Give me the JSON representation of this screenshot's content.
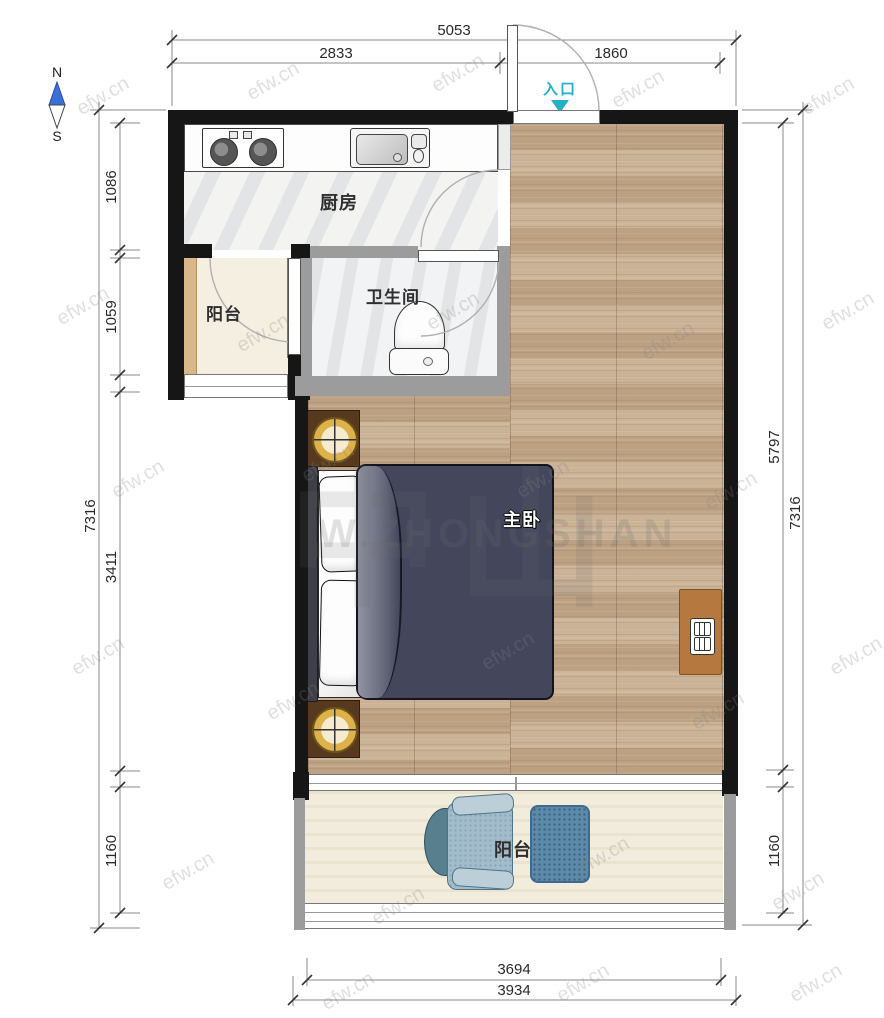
{
  "plan": {
    "compass": {
      "north": "N",
      "south": "S"
    },
    "entrance_label": "入口",
    "rooms": {
      "kitchen": "厨房",
      "bathroom": "卫生间",
      "balcony_left": "阳台",
      "master_bedroom": "主卧",
      "balcony_bottom": "阳台"
    },
    "dimensions_mm": {
      "top_total": "5053",
      "top_left": "2833",
      "top_right": "1860",
      "left_total": "7316",
      "left_seg_1": "1086",
      "left_seg_2": "1059",
      "left_seg_3": "3411",
      "left_seg_4": "1160",
      "right_inner": "5797",
      "right_total": "7316",
      "right_bottom": "1160",
      "bottom_inner": "3694",
      "bottom_outer": "3934"
    },
    "watermark": {
      "tile": "efw.cn",
      "center_cn": "中山",
      "center_en": "W.ZHONGSHAN"
    },
    "colors": {
      "wall": "#161616",
      "partition_wall": "#9c9c9c",
      "wood_floor": "#c7ae90",
      "entrance_accent": "#25b0c6",
      "duvet": "#44475c",
      "rug": "#5d8aa9"
    }
  }
}
